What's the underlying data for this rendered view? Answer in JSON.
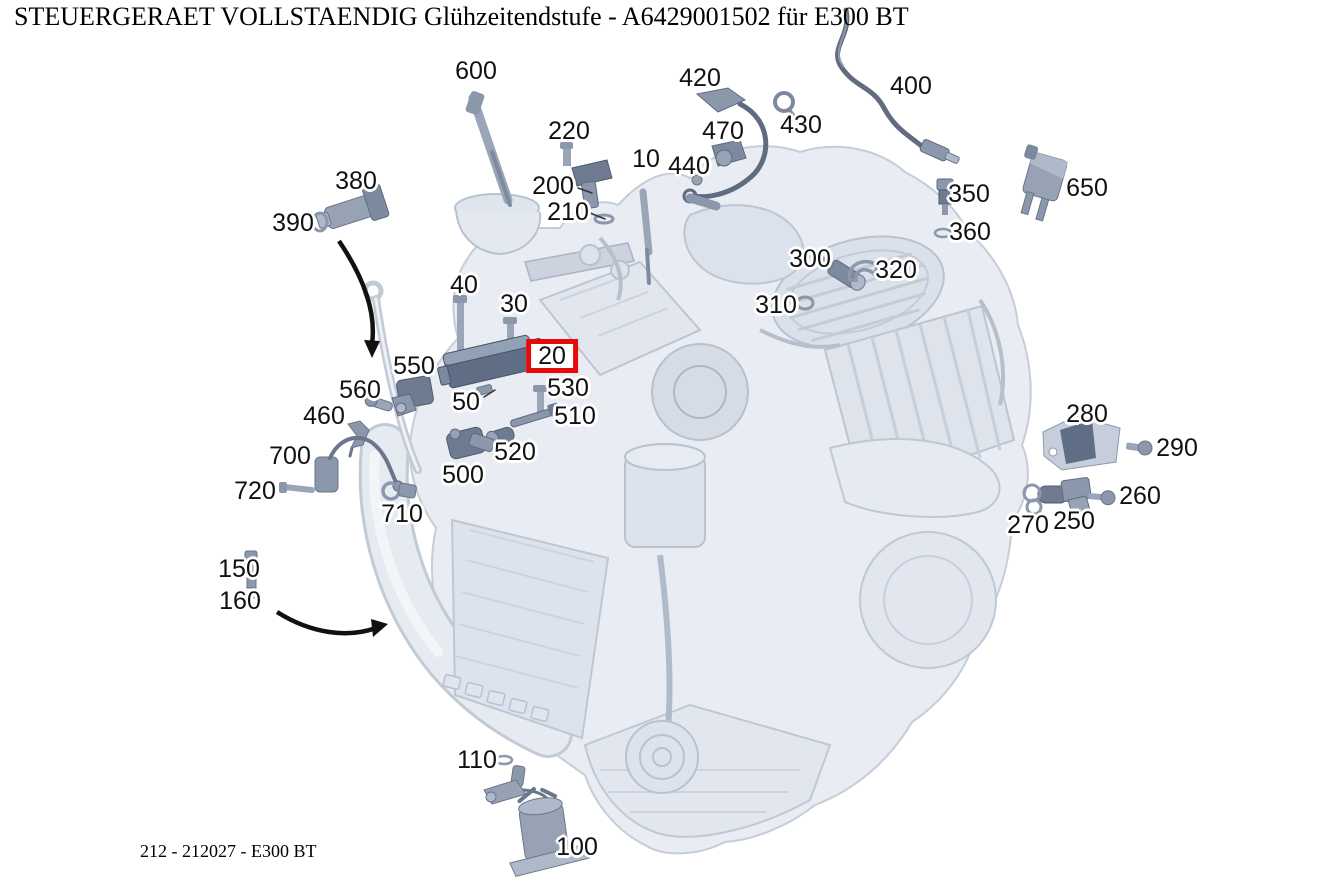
{
  "header": {
    "title": "STEUERGERAET VOLLSTAENDIG Glühzeitendstufe - A6429001502 für E300 BT"
  },
  "footer": {
    "reference": "212 - 212027 - E300 BT"
  },
  "diagram": {
    "description": "Exploded parts diagram of a V6 diesel engine, glow time output stage control unit highlighted",
    "highlight_color": "#e60b0b",
    "highlighted_callout": "20",
    "callouts": [
      {
        "label": "600",
        "x": 476,
        "y": 71
      },
      {
        "label": "420",
        "x": 700,
        "y": 78
      },
      {
        "label": "400",
        "x": 911,
        "y": 86
      },
      {
        "label": "220",
        "x": 569,
        "y": 131
      },
      {
        "label": "470",
        "x": 723,
        "y": 131
      },
      {
        "label": "430",
        "x": 801,
        "y": 125
      },
      {
        "label": "10",
        "x": 646,
        "y": 159
      },
      {
        "label": "440",
        "x": 689,
        "y": 166
      },
      {
        "label": "200",
        "x": 553,
        "y": 186
      },
      {
        "label": "210",
        "x": 568,
        "y": 212
      },
      {
        "label": "380",
        "x": 356,
        "y": 181
      },
      {
        "label": "390",
        "x": 293,
        "y": 223
      },
      {
        "label": "350",
        "x": 969,
        "y": 194
      },
      {
        "label": "360",
        "x": 970,
        "y": 232
      },
      {
        "label": "650",
        "x": 1087,
        "y": 188
      },
      {
        "label": "300",
        "x": 810,
        "y": 259
      },
      {
        "label": "320",
        "x": 896,
        "y": 270
      },
      {
        "label": "310",
        "x": 776,
        "y": 305
      },
      {
        "label": "40",
        "x": 464,
        "y": 285
      },
      {
        "label": "30",
        "x": 514,
        "y": 304
      },
      {
        "label": "20",
        "x": 552,
        "y": 356,
        "highlighted": true
      },
      {
        "label": "550",
        "x": 414,
        "y": 366
      },
      {
        "label": "530",
        "x": 568,
        "y": 388
      },
      {
        "label": "560",
        "x": 360,
        "y": 390
      },
      {
        "label": "50",
        "x": 466,
        "y": 402
      },
      {
        "label": "510",
        "x": 575,
        "y": 416
      },
      {
        "label": "460",
        "x": 324,
        "y": 416
      },
      {
        "label": "520",
        "x": 515,
        "y": 452
      },
      {
        "label": "700",
        "x": 290,
        "y": 456
      },
      {
        "label": "500",
        "x": 463,
        "y": 475
      },
      {
        "label": "280",
        "x": 1087,
        "y": 414
      },
      {
        "label": "290",
        "x": 1177,
        "y": 448
      },
      {
        "label": "720",
        "x": 255,
        "y": 491
      },
      {
        "label": "710",
        "x": 402,
        "y": 514
      },
      {
        "label": "260",
        "x": 1140,
        "y": 496
      },
      {
        "label": "270",
        "x": 1028,
        "y": 525
      },
      {
        "label": "250",
        "x": 1074,
        "y": 521
      },
      {
        "label": "150",
        "x": 239,
        "y": 569
      },
      {
        "label": "160",
        "x": 240,
        "y": 601
      },
      {
        "label": "110",
        "x": 477,
        "y": 760
      },
      {
        "label": "100",
        "x": 577,
        "y": 847
      }
    ]
  }
}
